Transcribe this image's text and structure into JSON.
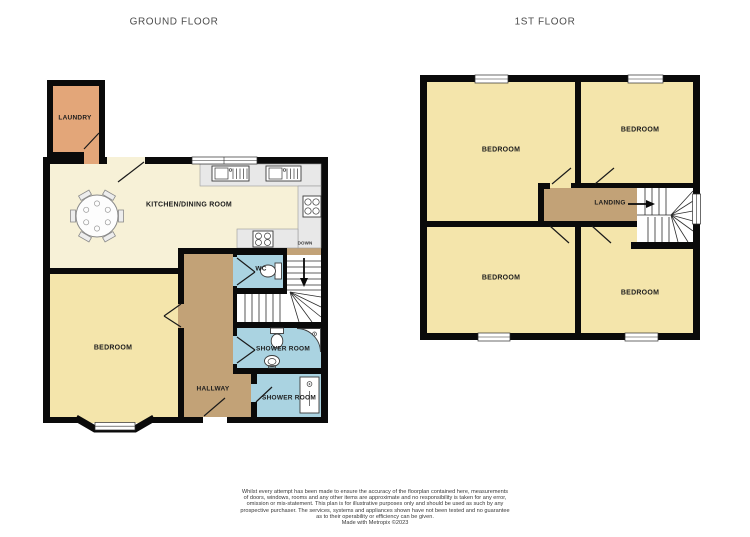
{
  "titles": {
    "ground": "GROUND FLOOR",
    "first": "1ST FLOOR"
  },
  "ground_floor": {
    "rooms": {
      "laundry": "LAUNDRY",
      "kitchen_dining": "KITCHEN/DINING ROOM",
      "bedroom": "BEDROOM",
      "hallway": "HALLWAY",
      "wc": "WC",
      "shower_room_1": "SHOWER ROOM",
      "shower_room_2": "SHOWER ROOM",
      "down": "DOWN"
    }
  },
  "first_floor": {
    "rooms": {
      "bedroom_top_left": "BEDROOM",
      "bedroom_top_right": "BEDROOM",
      "bedroom_bottom_left": "BEDROOM",
      "bedroom_bottom_right": "BEDROOM",
      "landing": "LANDING"
    }
  },
  "disclaimer": {
    "lines": [
      "Whilst every attempt has been made to ensure the accuracy of the floorplan contained here, measurements",
      "of doors, windows, rooms and any other items are approximate and no responsibility is taken for any error,",
      "omission or mis-statement. This plan is for illustrative purposes only and should be used as such by any",
      "prospective purchaser. The services, systems and appliances shown have not been tested and no guarantee",
      "as to their operability or efficiency can be given.",
      "Made with Metropix ©2023"
    ]
  },
  "colors": {
    "page": "#ffffff",
    "wall": "#0a0a0a",
    "laundry": "#e3a679",
    "kitchen": "#f7f1d7",
    "bedroom": "#f4e5ab",
    "hall": "#c2a277",
    "bath": "#aad3e1",
    "counter": "#e8e8e8",
    "counter-stroke": "#9a9a9a",
    "title": "#4d4d4d",
    "label": "#1c1c1c",
    "disclaimer": "#383838"
  }
}
